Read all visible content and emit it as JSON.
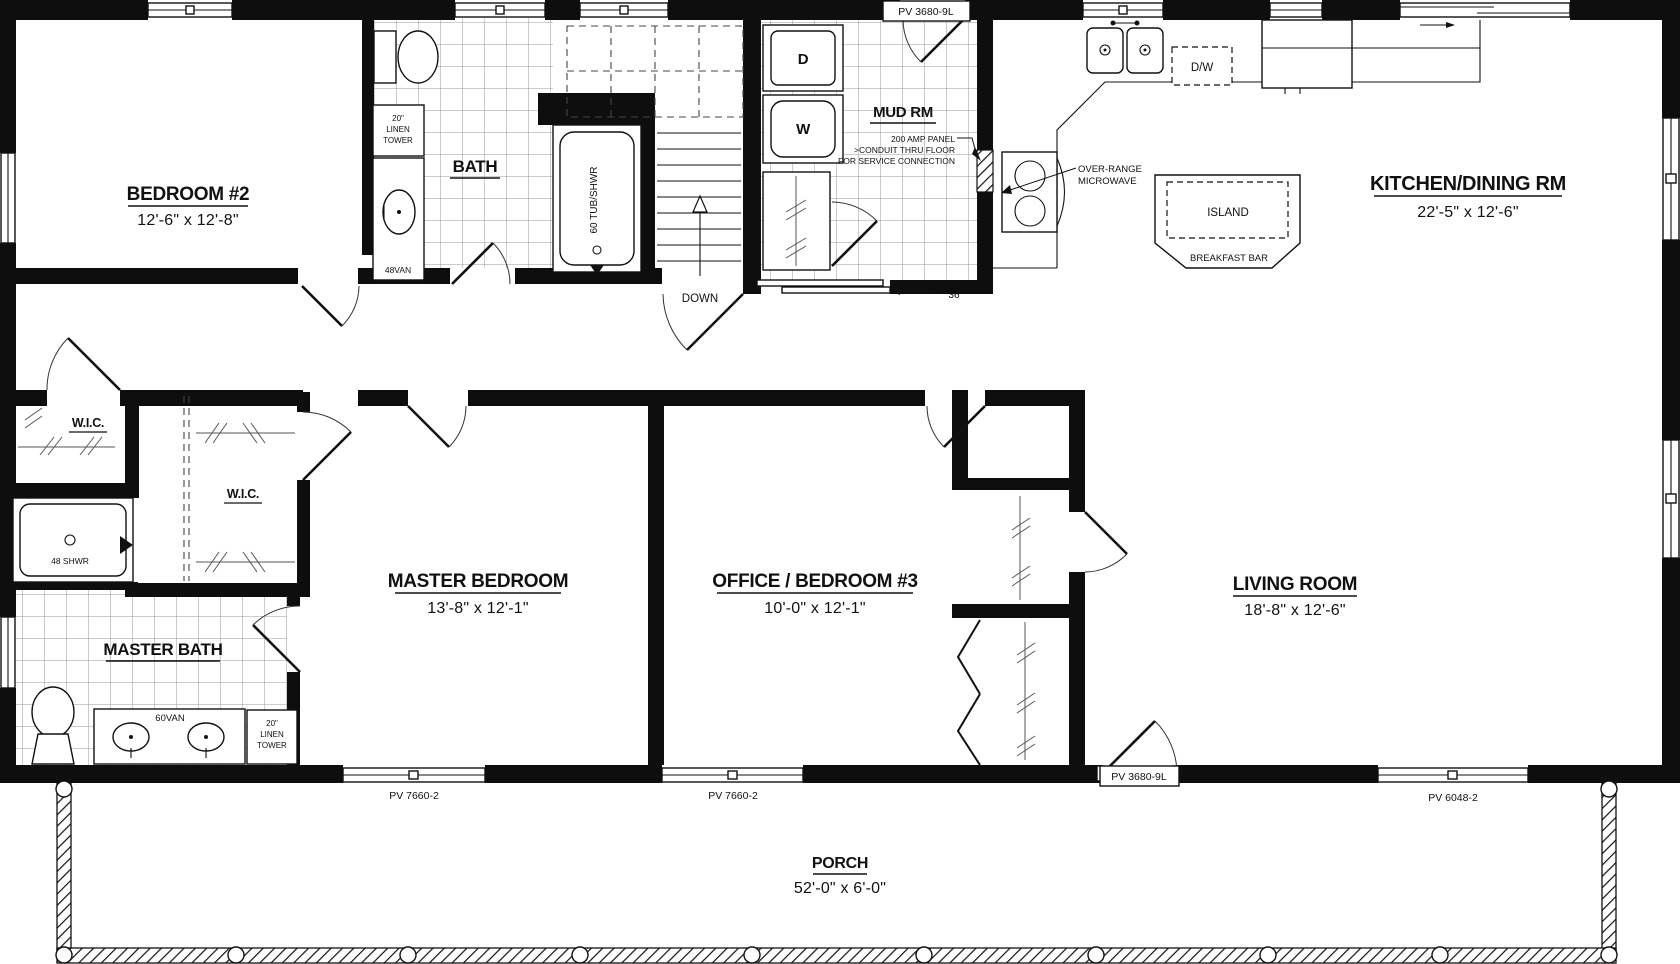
{
  "drawing": {
    "rooms": {
      "bedroom2": {
        "name": "BEDROOM #2",
        "dims": "12'-6\" x 12'-8\""
      },
      "bath": {
        "name": "BATH"
      },
      "mudroom": {
        "name": "MUD RM"
      },
      "kitchen": {
        "name": "KITCHEN/DINING RM",
        "dims": "22'-5\" x 12'-6\""
      },
      "wic1": {
        "name": "W.I.C."
      },
      "wic2": {
        "name": "W.I.C."
      },
      "master_bath": {
        "name": "MASTER BATH"
      },
      "master_bedroom": {
        "name": "MASTER BEDROOM",
        "dims": "13'-8\" x 12'-1\""
      },
      "office": {
        "name": "OFFICE / BEDROOM #3",
        "dims": "10'-0\" x 12'-1\""
      },
      "living": {
        "name": "LIVING ROOM",
        "dims": "18'-8\" x 12'-6\""
      },
      "porch": {
        "name": "PORCH",
        "dims": "52'-0\" x 6'-0\""
      }
    },
    "fixtures": {
      "linen_bath": {
        "line1": "20\"",
        "line2": "LINEN",
        "line3": "TOWER"
      },
      "vanity_bath": "48VAN",
      "tub": "60 TUB/SHWR",
      "shower": "48 SHWR",
      "dryer": "D",
      "washer": "W",
      "dishwasher": "D/W",
      "island": "ISLAND",
      "breakfast_bar": "BREAKFAST BAR",
      "vanity_master": "60VAN",
      "linen_master": {
        "line1": "20\"",
        "line2": "LINEN",
        "line3": "TOWER"
      }
    },
    "annotations": {
      "down": "DOWN",
      "door_width": "36",
      "panel_line1": "200 AMP PANEL",
      "panel_line2": ">CONDUIT THRU FLOOR",
      "panel_line3": "FOR SERVICE CONNECTION",
      "microwave_line1": "OVER-RANGE",
      "microwave_line2": "MICROWAVE"
    },
    "openings": {
      "top_door": "PV 3680-9L",
      "window_master": "PV 7660-2",
      "window_office": "PV 7660-2",
      "door_living": "PV 3680-9L",
      "window_living": "PV 6048-2"
    }
  }
}
